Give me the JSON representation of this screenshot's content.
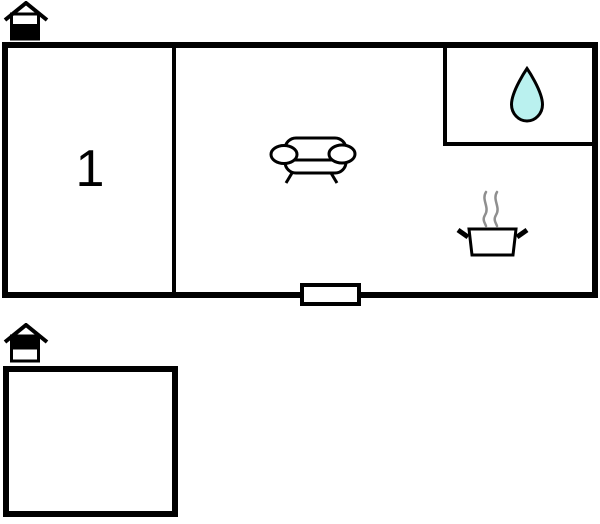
{
  "floor_plan": {
    "ground_floor": {
      "house_icon": "house-ground-floor-icon",
      "rooms": [
        {
          "name": "room-1",
          "label": "1"
        },
        {
          "name": "living-area",
          "icon": "sofa-icon"
        },
        {
          "name": "bathroom",
          "icon": "water-drop-icon"
        },
        {
          "name": "kitchen-area",
          "icon": "cooking-pot-icon"
        }
      ],
      "entrance_icon": "door-opening"
    },
    "upper_floor": {
      "house_icon": "house-upper-floor-icon",
      "rooms": [
        {
          "name": "room",
          "label": ""
        }
      ]
    }
  },
  "colors": {
    "walls": "#000000",
    "room_fill": "#ffffff",
    "water_drop_fill": "#baf1ef",
    "water_drop_outline": "#000000",
    "steam_stroke": "#8f8f8f"
  }
}
